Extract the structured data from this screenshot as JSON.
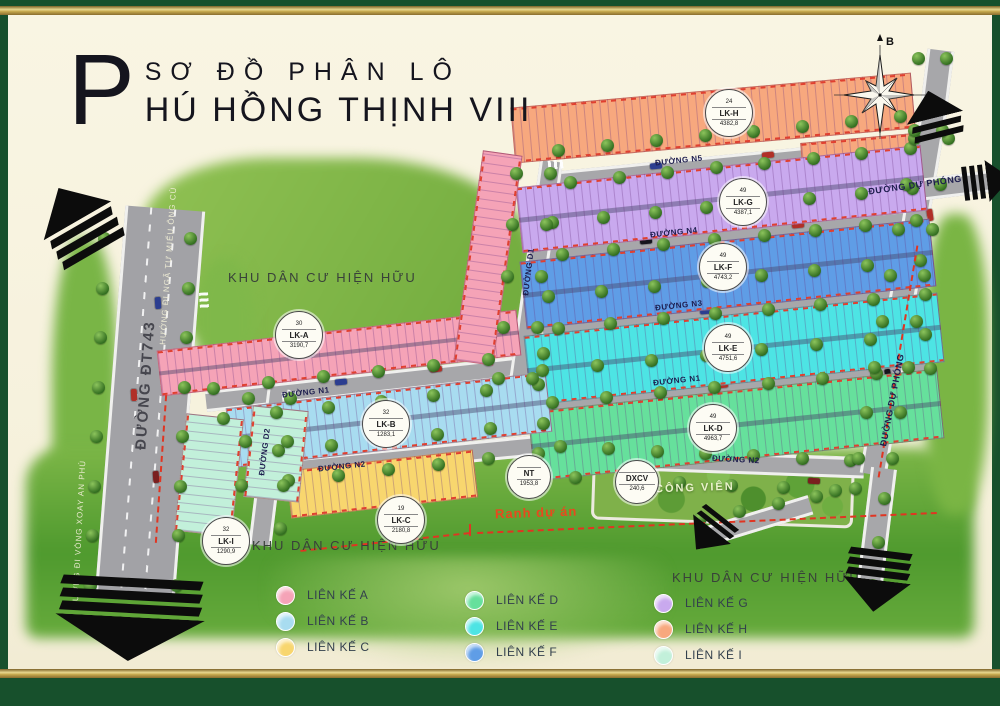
{
  "title": {
    "initial": "P",
    "line1": "SƠ ĐỒ PHÂN LÔ",
    "line2": "HÚ HỒNG THỊNH VIII"
  },
  "compass": {
    "north_label": "B"
  },
  "map": {
    "blocks": {
      "a": {
        "name": "LK-A",
        "lots": "30",
        "area": "3190,7",
        "color": "#f5a3b7"
      },
      "b": {
        "name": "LK-B",
        "lots": "32",
        "area": "1283,1",
        "color": "#a8dcf0"
      },
      "c": {
        "name": "LK-C",
        "lots": "19",
        "area": "2180,8",
        "color": "#f8d66e"
      },
      "d": {
        "name": "LK-D",
        "lots": "49",
        "area": "4963,7",
        "color": "#66e09c"
      },
      "e": {
        "name": "LK-E",
        "lots": "49",
        "area": "4751,6",
        "color": "#4de4e4"
      },
      "f": {
        "name": "LK-F",
        "lots": "49",
        "area": "4743,2",
        "color": "#5f9de6"
      },
      "g": {
        "name": "LK-G",
        "lots": "49",
        "area": "4387,1",
        "color": "#c9a9ee"
      },
      "h": {
        "name": "LK-H",
        "lots": "24",
        "area": "4382,8",
        "color": "#f7a87e"
      },
      "i": {
        "name": "LK-I",
        "lots": "32",
        "area": "1290,9",
        "color": "#c2f0da"
      }
    },
    "special": {
      "nt": {
        "name": "NT",
        "area": "1953,8"
      },
      "dxcv": {
        "name": "DXCV",
        "area": "240,6"
      }
    },
    "roads": {
      "dt743": {
        "name": "ĐƯỜNG ĐT743"
      },
      "n1": {
        "name": "ĐƯỜNG N1"
      },
      "n2": {
        "name": "ĐƯỜNG N2"
      },
      "n3": {
        "name": "ĐƯỜNG N3"
      },
      "n4": {
        "name": "ĐƯỜNG N4"
      },
      "n5": {
        "name": "ĐƯỜNG N5"
      },
      "d1": {
        "name": "ĐƯỜNG D1"
      },
      "d2": {
        "name": "ĐƯỜNG D2"
      },
      "du_phong": {
        "name": "ĐƯỜNG DỰ PHÓNG"
      }
    },
    "labels": {
      "existing_area": "KHU DÂN CƯ HIỆN HỮU",
      "park": "CÔNG VIÊN",
      "boundary": "Ranh dự án",
      "dir_mieu_ong_cu": "HƯỚNG ĐI NGÃ TƯ MIẾU ÔNG CÙ",
      "dir_an_phu": "HƯỚNG ĐI VÒNG XOAY AN PHÚ"
    }
  },
  "legend": {
    "items": [
      {
        "id": "a",
        "label": "LIÊN KẾ A",
        "color": "#f5a3b7"
      },
      {
        "id": "b",
        "label": "LIÊN KẾ B",
        "color": "#a8dcf0"
      },
      {
        "id": "c",
        "label": "LIÊN KẾ C",
        "color": "#f8d66e"
      },
      {
        "id": "d",
        "label": "LIÊN KẾ D",
        "color": "#66e09c"
      },
      {
        "id": "e",
        "label": "LIÊN KẾ E",
        "color": "#4de4e4"
      },
      {
        "id": "f",
        "label": "LIÊN KẾ F",
        "color": "#5f9de6"
      },
      {
        "id": "g",
        "label": "LIÊN KẾ G",
        "color": "#c9a9ee"
      },
      {
        "id": "h",
        "label": "LIÊN KẾ H",
        "color": "#f7a87e"
      },
      {
        "id": "i",
        "label": "LIÊN KẾ I",
        "color": "#c2f0da"
      }
    ]
  }
}
